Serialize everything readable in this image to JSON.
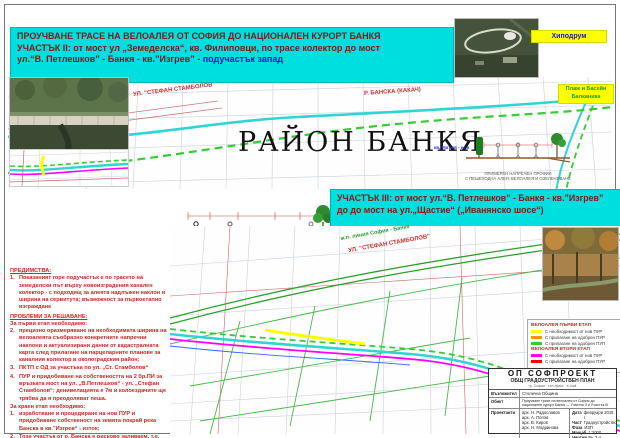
{
  "header": {
    "line1": "ПРОУЧВАНЕ ТРАСЕ НА ВЕЛОАЛЕЯ   ОТ  СОФИЯ   ДО НАЦИОНАЛЕН  КУРОРТ  БАНКЯ",
    "line2": "УЧАСТЪК II: от мост ул „Земеделска“, кв. Филиповци,   по трасе колектор до мост",
    "line3_prefix": "ул.“В. Петлешков” - Банкя - кв.”Изгрев” - ",
    "line3_highlight": "подучастък запад",
    "highlight_color": "#1515cc",
    "bar_color": "#00dfdf"
  },
  "section3": {
    "line1": "УЧАСТЪК III: от мост ул.“В. Петлешков” - Банкя - кв.”Изгрев”",
    "line2": "до до мост на ул.„Щастие“ („Иванянско шосе“)"
  },
  "map_labels": {
    "district_title": "РАЙОН БАНКЯ",
    "river": "Р. БАНСКА (КАКАЧ)",
    "street_upper": "УЛ. \"СТЕФАН СТАМБОЛОВ\"",
    "street_lower": "УЛ. \"СТЕФАН СТАМБОЛОВ\"",
    "railway": "ж.п. линия София - Банкя",
    "hippodrome": "Хиподрум",
    "beach": "Плаж и Басейн\nБалканика",
    "district_kv": "кв. Изгрев - нов"
  },
  "cross_sections": {
    "note": "ПЪРВОНАЧАЛНО РЕШЕНИЕ с организация на двупосочна велоалея в обхвата на съществуващото улично платно на ул. „Стефан Стамболов“",
    "caption": "ПРИМЕРЕН НАПРЕЧЕН ПРОФИЛ\nС ПЕШЕХОДНА АЛЕЯ, ВЕЛОАЛЕЯ И ОЗЕЛЕНЯВАНЕ"
  },
  "advantages": {
    "heading": "ПРЕДИМСТВА:",
    "items": [
      "Показаният горе подучастък е  по трасето на земеделски път върху новоизградения канален колектор - с  подходящ за алеята надлъжен наклон и ширина на сервитута; възможност за първоетапно изграждане"
    ],
    "numbers": [
      "1."
    ]
  },
  "problems": {
    "heading": "ПРОБЛЕМИ ЗА РЕШАВАНЕ:",
    "stage1_heading": "За първи етап необходимо:",
    "stage1_numbers": [
      "2.",
      "3.",
      "4."
    ],
    "stage1_items": [
      "прецизно оразмеряване на необходимата ширина на велоалеята съобразно конкретните напречни наклони и актуализирани данни от кадастралната карта след прилагане на парцеларните планове за каналния колектор в околоградския район;",
      "ПКТП с ОД за участъка по ул. „Ст. Стамболов“",
      "ПУР и придобиване на собствеността на 2 бр.ПИ за връзката мост на ул. „В.Петлешков“ - ул. „Стефан Стамболов“; денивелацията е 7м и колоездачите ще трябва да я преодоляват пеша."
    ],
    "stage2_heading": "За краен етап необходимо:",
    "stage2_numbers": [
      "1.",
      "2."
    ],
    "stage2_items": [
      "изработване и процедиране на  нов ПУР и придобиване собственост на земята покрай река Банска в кв.”Изгрев“ - изток;",
      "Този участък от р. Банска е рисково заливаем, т.е. нуждаещ се от реконструкция на  корекция"
    ]
  },
  "legend": {
    "stage1_title": "ВЕЛОАЛЕЯ ПЪРВИ ЕТАП",
    "stage2_title": "ВЕЛОАЛЕЯ ВТОРИ ЕТАП",
    "stage1_items": [
      {
        "color": "#ffff00",
        "label": "С необходимост от нов ПУР"
      },
      {
        "color": "#ff9000",
        "label": "С прилагане на одобрен ПУР"
      },
      {
        "color": "#33cc33",
        "label": "С прилагане на одобрен ПУП"
      }
    ],
    "stage2_items": [
      {
        "color": "#ff00ff",
        "label": "С необходимост от нов ПУР"
      },
      {
        "color": "#ff0000",
        "label": "С прилагане на одобрен ПУР"
      }
    ]
  },
  "title_block": {
    "company": "ОП  СОФПРОЕКТ",
    "plan": "ОБЩ ГРАДОУСТРОЙСТВЕН ПЛАН",
    "address": "гр. София  ·  тел./факс  ·  e-mail",
    "rows": [
      {
        "label": "Възложител",
        "value": "Столична Община"
      },
      {
        "label": "Обект",
        "value": "Проучване трасе на велоалея от София до национален курорт Банкя — Участък II и Участък III"
      },
      {
        "label": "Проектанти",
        "value": "арх. Н. Радославов\nарх. А. Попов\nарх. В. Киров\nарх. Н. Модринова"
      },
      {
        "label": "Директор",
        "value": "инж. И. Янев"
      }
    ],
    "meta": [
      {
        "label": "Дата",
        "value": "февруари 2015 г."
      },
      {
        "label": "Част",
        "value": "Градоустройство"
      },
      {
        "label": "Фаза",
        "value": "ИЗП"
      },
      {
        "label": "Мащаб",
        "value": "1:2000"
      },
      {
        "label": "Чертеж №",
        "value": "2-4"
      }
    ]
  },
  "colors": {
    "river": "#2fd4d4",
    "route_stage1": "#33cc33",
    "route_stage2": "#ff00ff",
    "cadastre": "#c8d2dc",
    "road_label": "#cc3030"
  }
}
